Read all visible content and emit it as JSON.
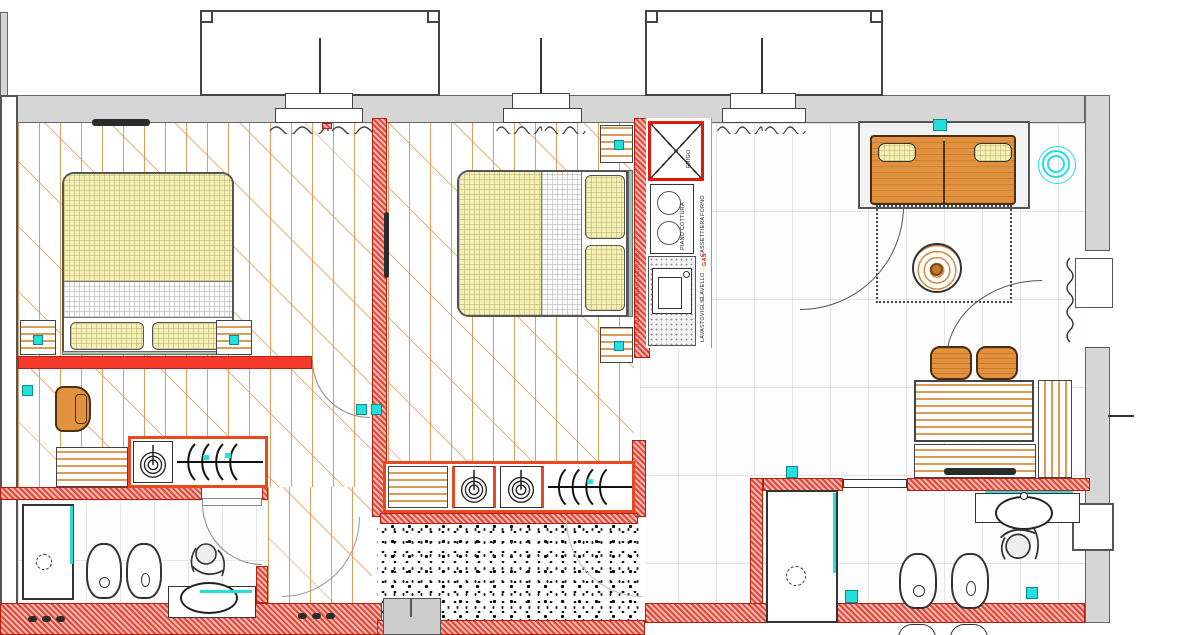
{
  "plan": {
    "kitchen": {
      "fridge_label": "FRIGO",
      "cooktop_label": "PIANO COTTURA",
      "oven_label": "FORNO",
      "drawers_label": "CASSETTIERA",
      "gas_label": "GAS",
      "sink_label": "LAVELLO",
      "dishwasher_label": "LAVASTOVIGLIE"
    },
    "annotations": {
      "bed_wall_note": "LETTO MATRIMONIALE 160X200"
    },
    "colors": {
      "wall_gray": "#d6d6d6",
      "wall_red": "#e2473a",
      "accent_red": "#f5392b",
      "wood_line": "#dd9955",
      "furniture_orange": "#e2913f",
      "textile_yellow": "#f5f0b6",
      "fixture_cyan": "#25dede"
    }
  }
}
